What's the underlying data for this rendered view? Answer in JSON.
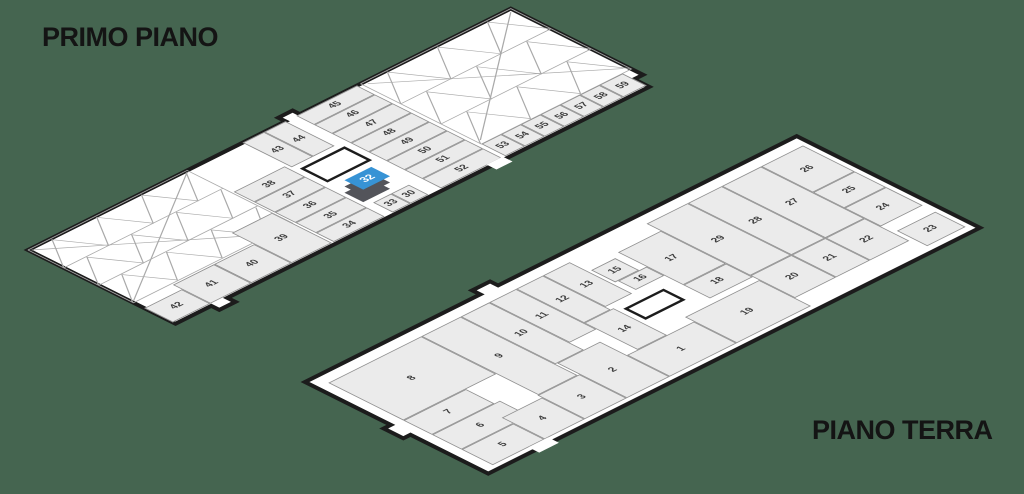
{
  "background_color": "#456550",
  "floor_fill": "#ffffff",
  "cell_fill": "#ebebeb",
  "cell_border": "#8f8f8f",
  "outline_color": "#1c1c1c",
  "floors": [
    {
      "id": "primo-piano",
      "title": "PRIMO PIANO",
      "w": 540,
      "h": 165,
      "outline": "0,0 288,0 288,-8 304,-8 304,0 540,0 540,148 530,148 530,165 58,165 58,174 40,174 40,165 0,165",
      "booths": [
        {
          "n": "42",
          "x": 0,
          "y": 130,
          "w": 42,
          "h": 32
        },
        {
          "n": "41",
          "x": 42,
          "y": 120,
          "w": 46,
          "h": 42
        },
        {
          "n": "40",
          "x": 88,
          "y": 120,
          "w": 45,
          "h": 42
        },
        {
          "n": "39",
          "x": 133,
          "y": 95,
          "w": 45,
          "h": 67
        },
        {
          "n": "38",
          "x": 180,
          "y": 50,
          "w": 57,
          "h": 23
        },
        {
          "n": "37",
          "x": 180,
          "y": 73,
          "w": 57,
          "h": 23
        },
        {
          "n": "36",
          "x": 180,
          "y": 96,
          "w": 57,
          "h": 23
        },
        {
          "n": "35",
          "x": 180,
          "y": 119,
          "w": 57,
          "h": 23
        },
        {
          "n": "34",
          "x": 180,
          "y": 142,
          "w": 57,
          "h": 20
        },
        {
          "n": "43",
          "x": 240,
          "y": 0,
          "w": 24,
          "h": 55
        },
        {
          "n": "44",
          "x": 264,
          "y": 0,
          "w": 24,
          "h": 55
        },
        {
          "n": "33",
          "x": 246,
          "y": 140,
          "w": 20,
          "h": 22
        },
        {
          "n": "30",
          "x": 266,
          "y": 140,
          "w": 20,
          "h": 22
        },
        {
          "n": "45",
          "x": 300,
          "y": 0,
          "w": 68,
          "h": 20
        },
        {
          "n": "46",
          "x": 300,
          "y": 20,
          "w": 68,
          "h": 20
        },
        {
          "n": "47",
          "x": 300,
          "y": 40,
          "w": 68,
          "h": 21
        },
        {
          "n": "48",
          "x": 300,
          "y": 61,
          "w": 68,
          "h": 20
        },
        {
          "n": "49",
          "x": 300,
          "y": 81,
          "w": 68,
          "h": 20
        },
        {
          "n": "50",
          "x": 300,
          "y": 101,
          "w": 68,
          "h": 20
        },
        {
          "n": "51",
          "x": 300,
          "y": 121,
          "w": 68,
          "h": 20
        },
        {
          "n": "52",
          "x": 300,
          "y": 141,
          "w": 68,
          "h": 21
        },
        {
          "n": "53",
          "x": 372,
          "y": 135,
          "w": 22,
          "h": 27
        },
        {
          "n": "54",
          "x": 394,
          "y": 135,
          "w": 22,
          "h": 27
        },
        {
          "n": "55",
          "x": 416,
          "y": 135,
          "w": 22,
          "h": 27
        },
        {
          "n": "56",
          "x": 438,
          "y": 135,
          "w": 22,
          "h": 27
        },
        {
          "n": "57",
          "x": 460,
          "y": 135,
          "w": 22,
          "h": 27
        },
        {
          "n": "58",
          "x": 482,
          "y": 135,
          "w": 22,
          "h": 27
        },
        {
          "n": "59",
          "x": 504,
          "y": 135,
          "w": 26,
          "h": 27
        }
      ],
      "mesh_zones": [
        {
          "x": 0,
          "y": 0,
          "w": 178,
          "h": 118,
          "polylines": [
            "0,0 178,0 178,118 0,118 0,0",
            "0,40 178,40",
            "0,79 178,79",
            "0,40 25,2 50,40 75,2 100,40 125,2 150,40 175,2",
            "0,79 25,41 50,79 75,41 100,79 125,41 150,79 175,41",
            "0,117 25,80 50,117 75,80 100,117 125,80 150,117 175,80",
            "2,116 176,2",
            "2,2 150,116"
          ]
        },
        {
          "x": 372,
          "y": 0,
          "w": 168,
          "h": 135,
          "polylines": [
            "0,0 168,0 168,135 0,135 0,0",
            "0,45 168,45",
            "0,90 168,90",
            "0,45 28,2 56,45 84,2 112,45 140,2 168,45",
            "0,90 28,46 56,90 84,46 112,90 140,46 168,90",
            "0,134 28,91 56,134 84,91 112,134 140,91 168,134",
            "4,130 164,4",
            "4,4 164,130"
          ]
        }
      ],
      "stairwell": {
        "x": 243,
        "y": 61,
        "w": 50,
        "h": 31
      },
      "doors": [
        {
          "x": 352,
          "y": 161,
          "w": 18,
          "h": 11
        }
      ],
      "highlight_box": {
        "label": "32",
        "x": 255,
        "y": 99,
        "w": 30,
        "h": 21,
        "dx": -14,
        "dy": 14,
        "top_color": "#3793d5",
        "side_color": "#53545a",
        "text_color": "#ffffff"
      }
    },
    {
      "id": "piano-terra",
      "title": "PIANO TERRA",
      "w": 550,
      "h": 205,
      "outline": "0,0 196,0 196,-9 216,-9 216,0 550,0 550,205 0,205 0,118 -8,118 -8,96 0,96",
      "booths": [
        {
          "n": "8",
          "x": 12,
          "y": 14,
          "w": 104,
          "h": 84
        },
        {
          "n": "7",
          "x": 12,
          "y": 98,
          "w": 70,
          "h": 32
        },
        {
          "n": "6",
          "x": 12,
          "y": 130,
          "w": 76,
          "h": 33
        },
        {
          "n": "5",
          "x": 12,
          "y": 163,
          "w": 58,
          "h": 35
        },
        {
          "n": "4",
          "x": 70,
          "y": 150,
          "w": 45,
          "h": 48
        },
        {
          "n": "3",
          "x": 115,
          "y": 145,
          "w": 47,
          "h": 53
        },
        {
          "n": "2",
          "x": 162,
          "y": 120,
          "w": 48,
          "h": 78
        },
        {
          "n": "9",
          "x": 116,
          "y": 14,
          "w": 44,
          "h": 131
        },
        {
          "n": "10",
          "x": 160,
          "y": 14,
          "w": 32,
          "h": 106
        },
        {
          "n": "11",
          "x": 192,
          "y": 14,
          "w": 30,
          "h": 90
        },
        {
          "n": "12",
          "x": 222,
          "y": 14,
          "w": 30,
          "h": 76
        },
        {
          "n": "13",
          "x": 252,
          "y": 14,
          "w": 30,
          "h": 70
        },
        {
          "n": "14",
          "x": 222,
          "y": 90,
          "w": 33,
          "h": 60
        },
        {
          "n": "1",
          "x": 210,
          "y": 150,
          "w": 75,
          "h": 48
        },
        {
          "n": "15",
          "x": 285,
          "y": 35,
          "w": 27,
          "h": 27
        },
        {
          "n": "16",
          "x": 288,
          "y": 62,
          "w": 32,
          "h": 20
        },
        {
          "n": "17",
          "x": 320,
          "y": 30,
          "w": 48,
          "h": 73
        },
        {
          "n": "18",
          "x": 320,
          "y": 103,
          "w": 48,
          "h": 30
        },
        {
          "n": "19",
          "x": 285,
          "y": 140,
          "w": 83,
          "h": 58
        },
        {
          "n": "20",
          "x": 368,
          "y": 130,
          "w": 46,
          "h": 50
        },
        {
          "n": "21",
          "x": 414,
          "y": 130,
          "w": 38,
          "h": 50
        },
        {
          "n": "22",
          "x": 452,
          "y": 130,
          "w": 44,
          "h": 50
        },
        {
          "n": "29",
          "x": 368,
          "y": 14,
          "w": 46,
          "h": 116
        },
        {
          "n": "28",
          "x": 414,
          "y": 14,
          "w": 38,
          "h": 116
        },
        {
          "n": "27",
          "x": 452,
          "y": 14,
          "w": 44,
          "h": 116
        },
        {
          "n": "26",
          "x": 496,
          "y": 14,
          "w": 47,
          "h": 58
        },
        {
          "n": "25",
          "x": 496,
          "y": 72,
          "w": 47,
          "h": 35
        },
        {
          "n": "24",
          "x": 496,
          "y": 107,
          "w": 47,
          "h": 41
        },
        {
          "n": "23",
          "x": 500,
          "y": 162,
          "w": 43,
          "h": 34
        }
      ],
      "mesh_zones": [],
      "stairwell": {
        "x": 260,
        "y": 96,
        "w": 45,
        "h": 25
      },
      "doors": [
        {
          "x": 52,
          "y": 198,
          "w": 22,
          "h": 12
        }
      ],
      "highlight_box": null
    }
  ]
}
